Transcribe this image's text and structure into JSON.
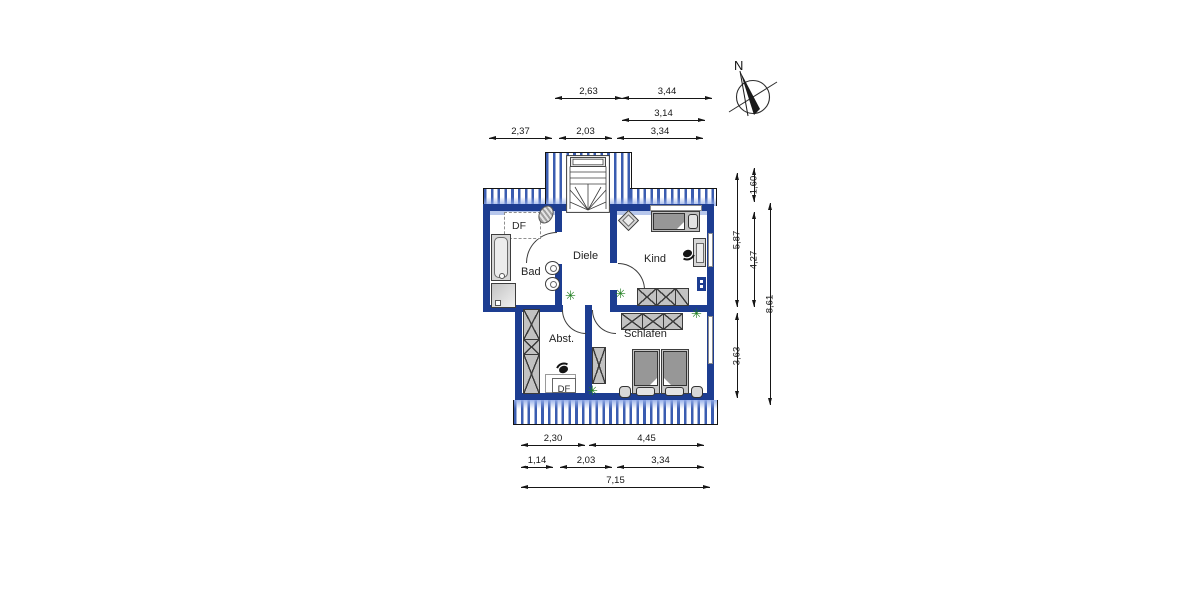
{
  "compass": {
    "label": "N"
  },
  "rooms": {
    "bad": "Bad",
    "diele": "Diele",
    "kind": "Kind",
    "abst": "Abst.",
    "schlafen": "Schlafen"
  },
  "roof_windows": {
    "bad_df": "DF",
    "abst_df": "DF"
  },
  "colors": {
    "wall": "#1d3d91",
    "stripe": "#3a5cb0",
    "knee": "#b7c7ec",
    "furn": "#d6d6d6",
    "plant": "#1e7d1e"
  },
  "plant_glyph": "✳",
  "dimensions": [
    {
      "id": "top-a1",
      "axis": "h",
      "x1": 555,
      "x2": 622,
      "y": 98,
      "label": "2,63"
    },
    {
      "id": "top-a2",
      "axis": "h",
      "x1": 622,
      "x2": 712,
      "y": 98,
      "label": "3,44"
    },
    {
      "id": "top-b1",
      "axis": "h",
      "x1": 622,
      "x2": 705,
      "y": 120,
      "label": "3,14"
    },
    {
      "id": "top-c1",
      "axis": "h",
      "x1": 489,
      "x2": 552,
      "y": 138,
      "label": "2,37"
    },
    {
      "id": "top-c2",
      "axis": "h",
      "x1": 559,
      "x2": 612,
      "y": 138,
      "label": "2,03"
    },
    {
      "id": "top-c3",
      "axis": "h",
      "x1": 617,
      "x2": 703,
      "y": 138,
      "label": "3,34"
    },
    {
      "id": "right-a1",
      "axis": "v",
      "x": 737,
      "y1": 173,
      "y2": 307,
      "label": "5,87"
    },
    {
      "id": "right-a2",
      "axis": "v",
      "x": 737,
      "y1": 313,
      "y2": 398,
      "label": "3,63"
    },
    {
      "id": "right-b1",
      "axis": "v",
      "x": 754,
      "y1": 168,
      "y2": 202,
      "label": "1,60"
    },
    {
      "id": "right-b2",
      "axis": "v",
      "x": 754,
      "y1": 212,
      "y2": 307,
      "label": "4,27"
    },
    {
      "id": "right-c1",
      "axis": "v",
      "x": 770,
      "y1": 203,
      "y2": 405,
      "label": "8,61"
    },
    {
      "id": "bot-a1",
      "axis": "h",
      "x1": 521,
      "x2": 585,
      "y": 445,
      "label": "2,30"
    },
    {
      "id": "bot-a2",
      "axis": "h",
      "x1": 589,
      "x2": 704,
      "y": 445,
      "label": "4,45"
    },
    {
      "id": "bot-b1",
      "axis": "h",
      "x1": 521,
      "x2": 553,
      "y": 467,
      "label": "1,14"
    },
    {
      "id": "bot-b2",
      "axis": "h",
      "x1": 560,
      "x2": 612,
      "y": 467,
      "label": "2,03"
    },
    {
      "id": "bot-b3",
      "axis": "h",
      "x1": 617,
      "x2": 704,
      "y": 467,
      "label": "3,34"
    },
    {
      "id": "bot-c1",
      "axis": "h",
      "x1": 521,
      "x2": 710,
      "y": 487,
      "label": "7,15"
    }
  ]
}
